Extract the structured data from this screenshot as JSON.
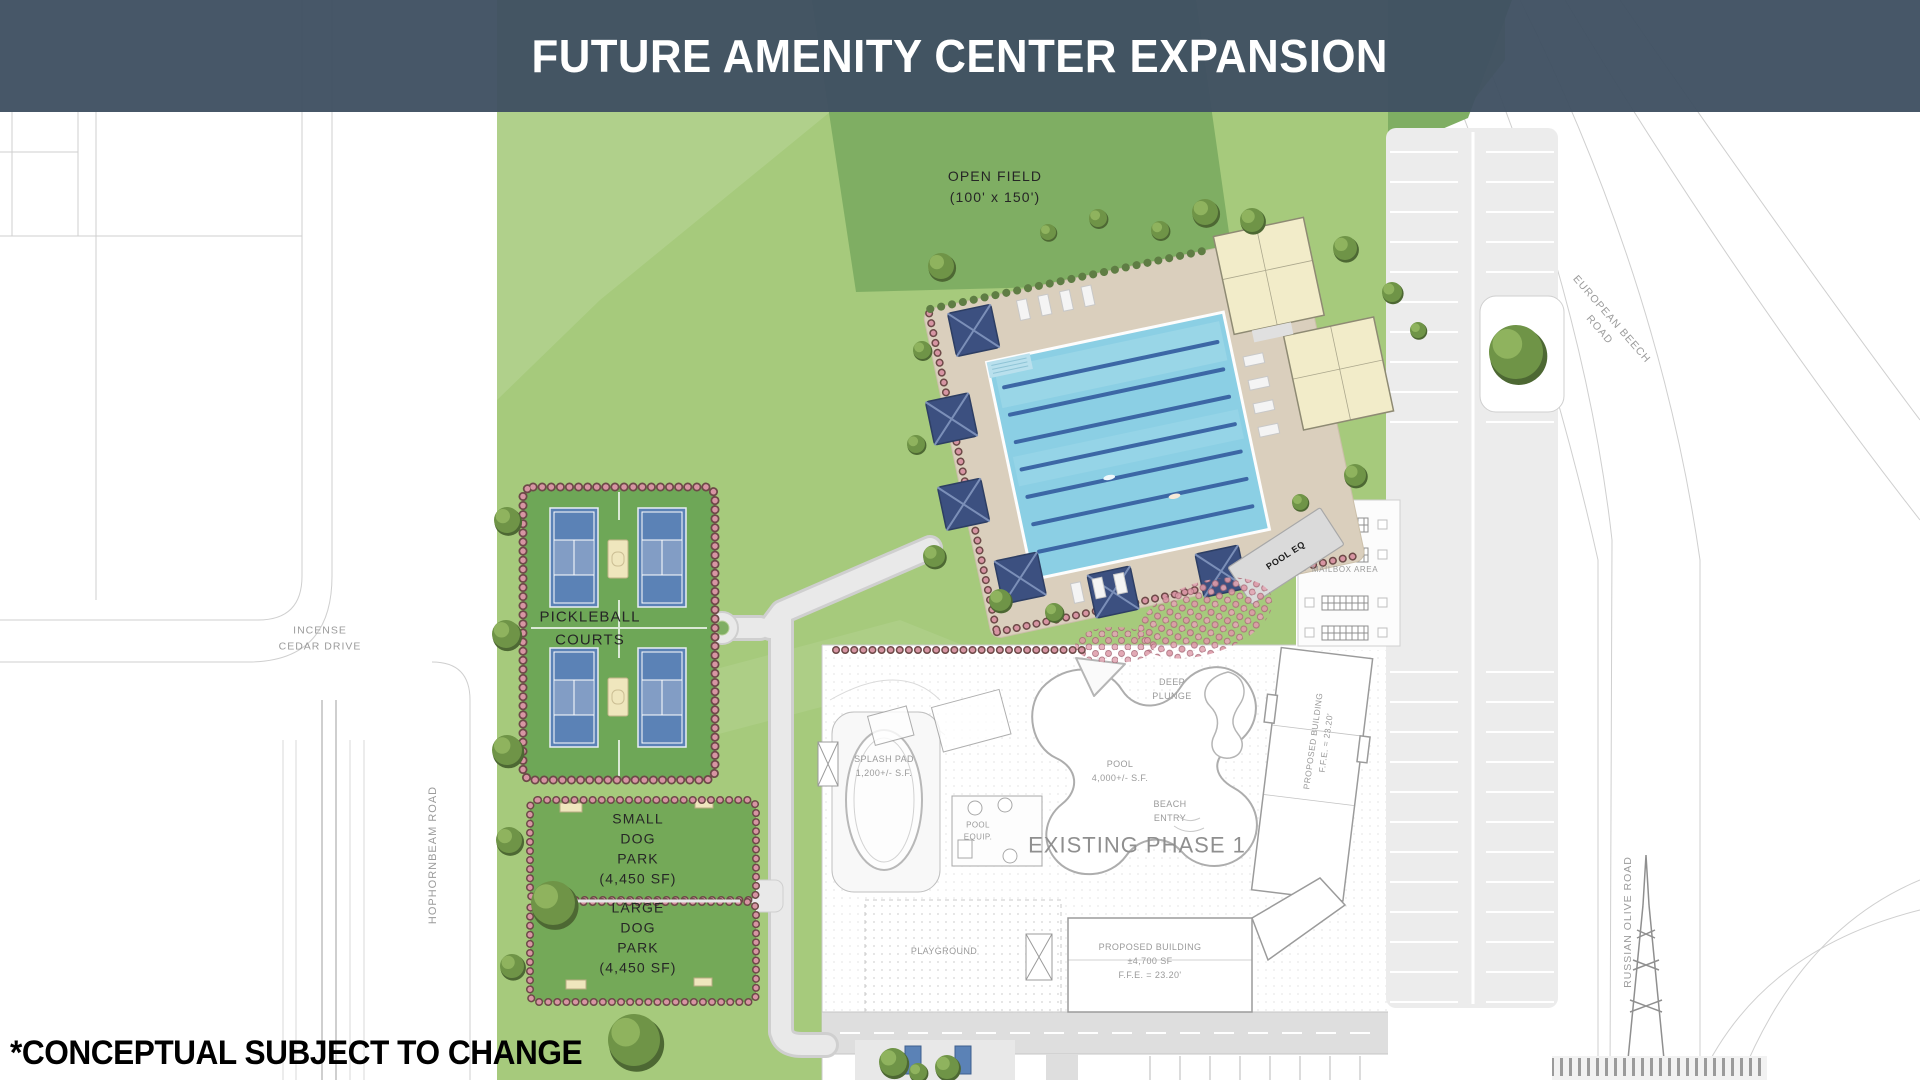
{
  "banner": {
    "title": "FUTURE AMENITY CENTER EXPANSION"
  },
  "notes": {
    "disclaimer": "*CONCEPTUAL SUBJECT TO CHANGE"
  },
  "site": {
    "open_field": "OPEN FIELD\n(100' x 150')",
    "pickleball": "PICKLEBALL\nCOURTS",
    "small_dog_park": "SMALL\nDOG\nPARK\n(4,450 SF)",
    "large_dog_park": "LARGE\nDOG\nPARK\n(4,450 SF)",
    "pool_eq": "POOL EQ",
    "mailbox_area": "MAILBOX AREA"
  },
  "phase1": {
    "heading": "EXISTING PHASE 1",
    "splash_pad": "SPLASH PAD\n1,200+/- S.F.",
    "pool_equip": "POOL\nEQUIP.",
    "deep_plunge": "DEEP\nPLUNGE",
    "pool": "POOL\n4,000+/- S.F.",
    "beach_entry": "BEACH\nENTRY",
    "playground": "PLAYGROUND",
    "proposed_building_side": "PROPOSED BUILDING\nF.F.E. = 23.20'",
    "proposed_building_main": "PROPOSED BUILDING\n±4,700 SF\nF.F.E. = 23.20'"
  },
  "roads": {
    "incense_cedar": "INCENSE\nCEDAR DRIVE",
    "hophornbeam": "HOPHORNBEAM ROAD",
    "european_beech": "EUROPEAN BEECH\nROAD",
    "russian_olive": "RUSSIAN OLIVE ROAD"
  },
  "colors": {
    "banner_bg": "#425263",
    "grass": "#A6CA7C",
    "open_field": "#7FAE63",
    "pool_water": "#8BCFE4",
    "cabana_navy": "#3C5080",
    "court_blue": "#5B82B6",
    "hedge_pink": "#D795A3",
    "deck_tan": "#DACFBD"
  }
}
